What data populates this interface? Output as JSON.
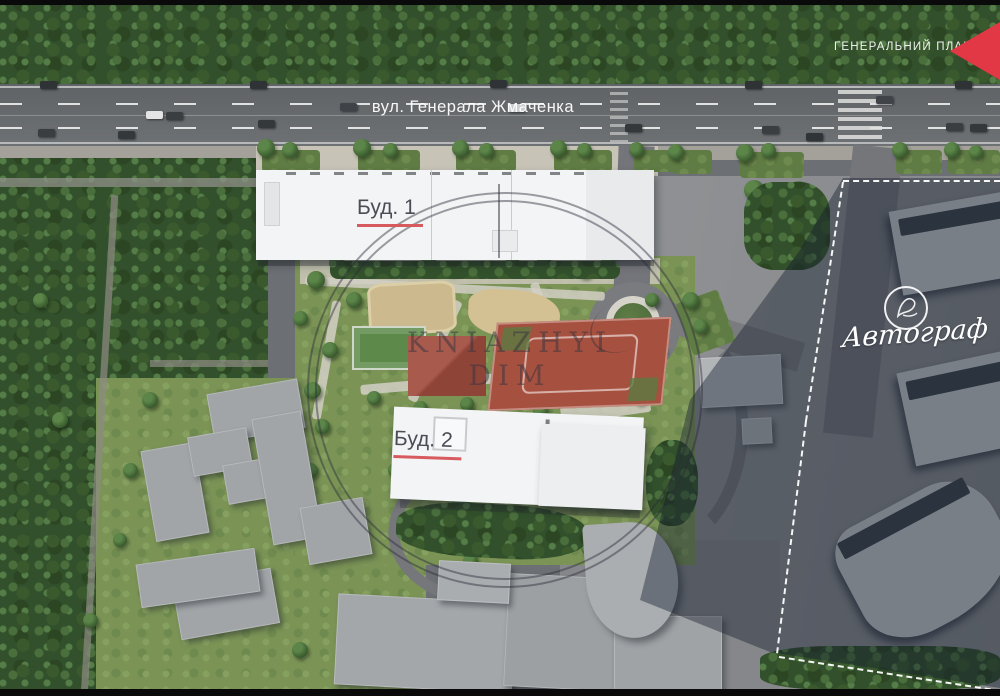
{
  "plan": {
    "title": "ГЕНЕРАЛЬНИЙ ПЛАН"
  },
  "street": {
    "name": "вул. Генерала Жмаченка"
  },
  "buildings": {
    "bud1": "Буд. 1",
    "bud2": "Буд. 2"
  },
  "neighbor": {
    "name": "Автограф"
  },
  "watermark": {
    "text": "KNIAZHYI DIM"
  },
  "colors": {
    "arrow_red": "#e23744",
    "label_underline_red": "#d75b5e",
    "label_text": "#4b4c55",
    "new_building_white": "#f3f4f5",
    "existing_building_gray": "#a2a5a8",
    "road_asphalt": "#646米7"
  }
}
